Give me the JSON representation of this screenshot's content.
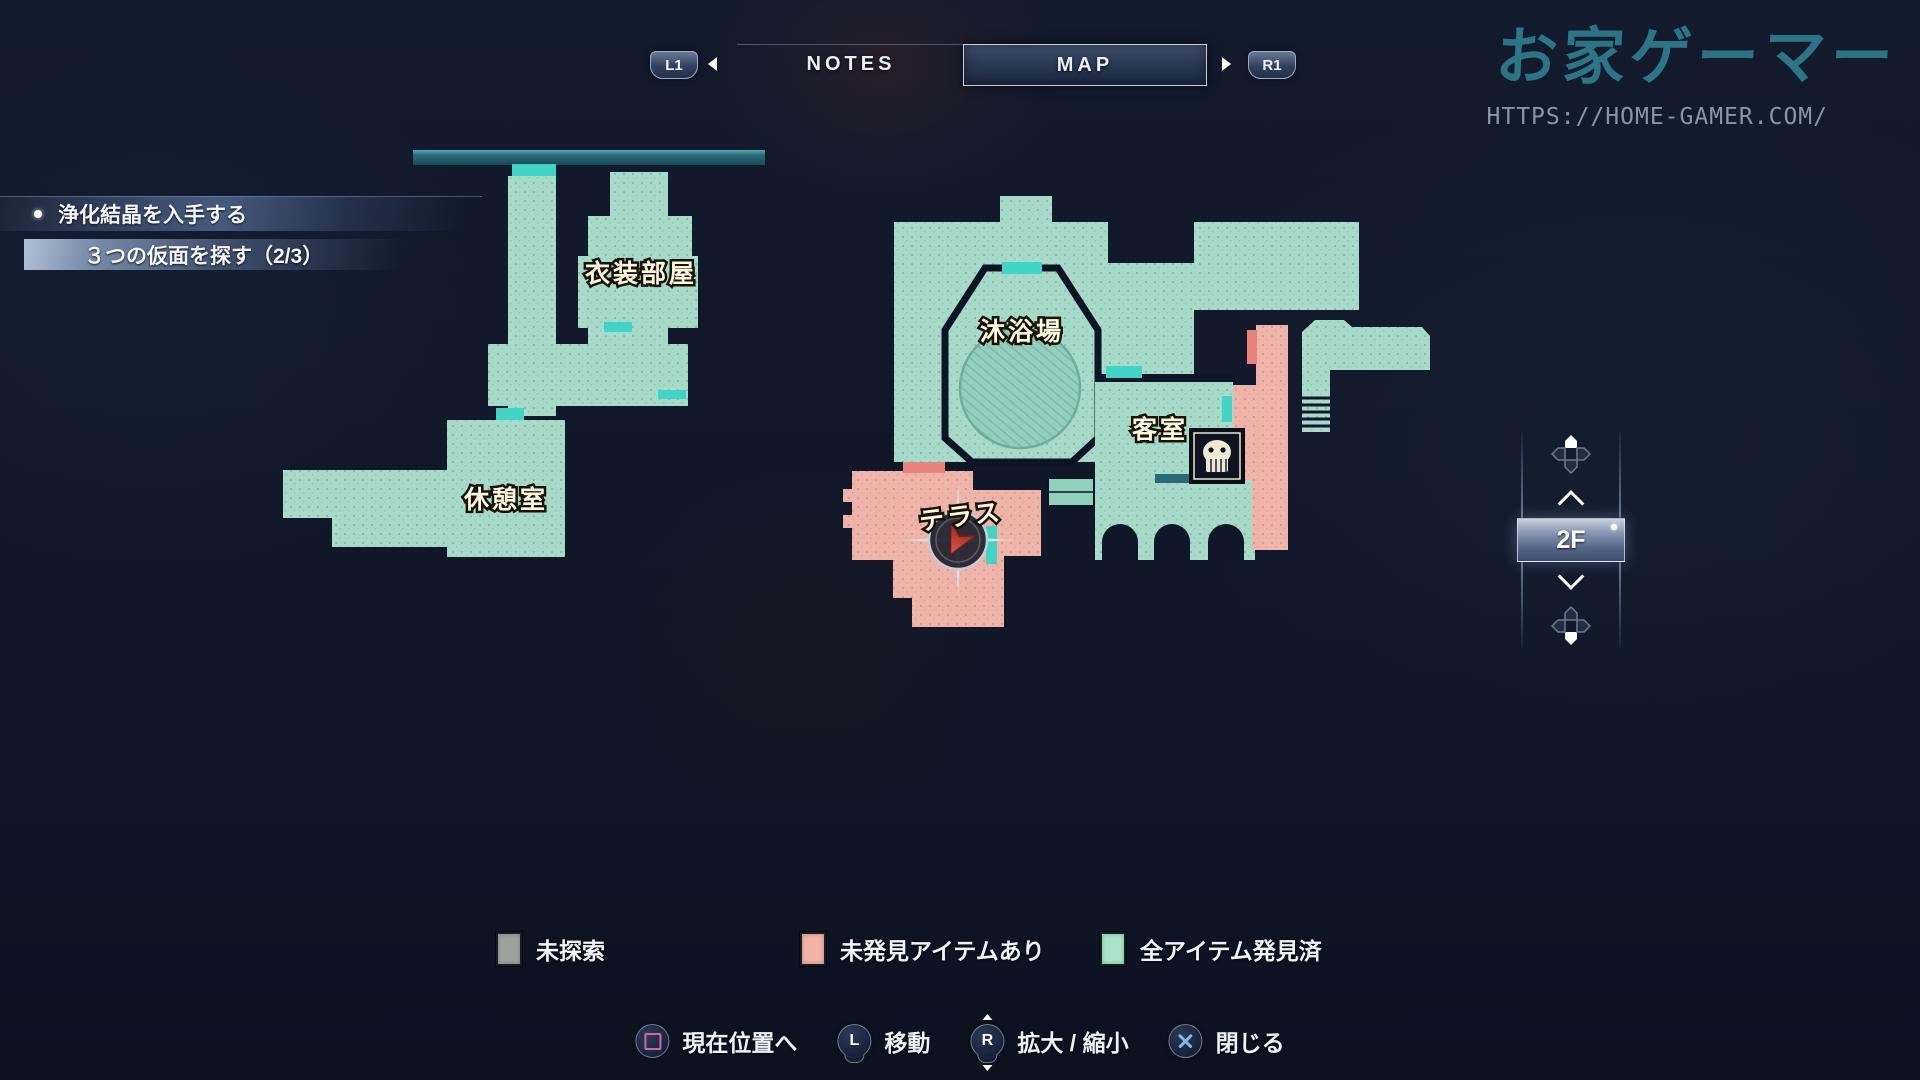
{
  "header": {
    "l1_label": "L1",
    "r1_label": "R1",
    "tabs": [
      {
        "label": "NOTES",
        "active": false
      },
      {
        "label": "MAP",
        "active": true
      }
    ]
  },
  "watermark": {
    "title": "お家ゲーマー",
    "url": "HTTPS://HOME-GAMER.COM/",
    "title_color": "#2e7e8e"
  },
  "quests": [
    {
      "text": "浄化結晶を入手する",
      "bulleted": true
    },
    {
      "text": "３つの仮面を探す（2/3）",
      "bulleted": false
    }
  ],
  "map": {
    "rooms": [
      {
        "name": "衣装部屋"
      },
      {
        "name": "沐浴場"
      },
      {
        "name": "客室"
      },
      {
        "name": "休憩室"
      },
      {
        "name": "テラス"
      }
    ],
    "colors": {
      "explored": "#a7dac8",
      "items_remaining": "#eeb4a9",
      "unexplored": "#9aa0a0",
      "door": "#3fd4c6",
      "door_red": "#e8837c",
      "marker_red": "#c63a2c"
    },
    "icons": [
      "player-position-marker",
      "mask-item-icon"
    ]
  },
  "floor_selector": {
    "current": "2F"
  },
  "legend": [
    {
      "label": "未探索",
      "color": "#9aa49f"
    },
    {
      "label": "未発見アイテムあり",
      "color": "#f2b3a6"
    },
    {
      "label": "全アイテム発見済",
      "color": "#abe3c6"
    }
  ],
  "controls": [
    {
      "button": "square",
      "button_label": "",
      "label": "現在位置へ"
    },
    {
      "button": "left-stick",
      "button_label": "L",
      "label": "移動"
    },
    {
      "button": "right-stick",
      "button_label": "R",
      "label": "拡大 / 縮小"
    },
    {
      "button": "cross",
      "button_label": "",
      "label": "閉じる"
    }
  ]
}
